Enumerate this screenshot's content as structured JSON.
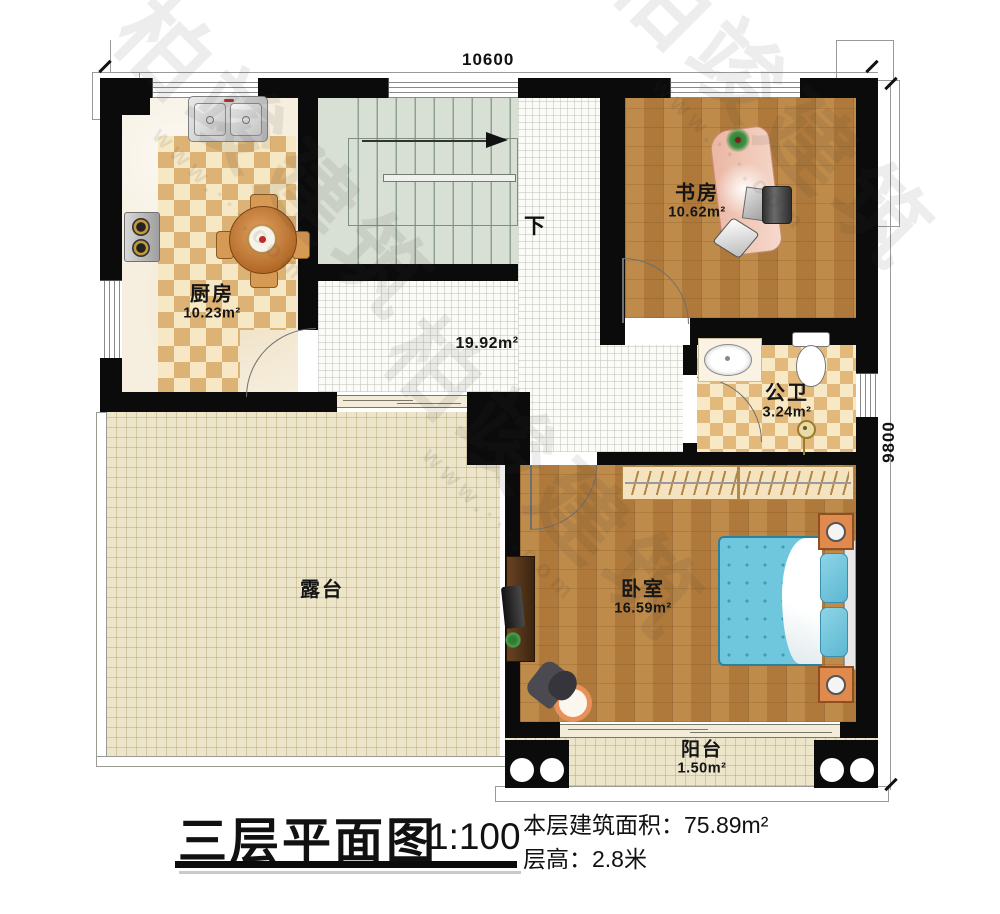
{
  "dimensions": {
    "top": "10600",
    "right": "9800"
  },
  "stairs": {
    "down_label": "下"
  },
  "rooms": {
    "kitchen": {
      "name": "厨房",
      "area": "10.23m²"
    },
    "study": {
      "name": "书房",
      "area": "10.62m²"
    },
    "bathroom": {
      "name": "公卫",
      "area": "3.24m²"
    },
    "bedroom": {
      "name": "卧室",
      "area": "16.59m²"
    },
    "hallway": {
      "area": "19.92m²"
    },
    "terrace": {
      "name": "露台"
    },
    "balcony": {
      "name": "阳台",
      "area": "1.50m²"
    }
  },
  "title_block": {
    "title": "三层平面图",
    "scale": "1:100",
    "area_label": "本层建筑面积：",
    "area_value": "75.89m²",
    "height_label": "层高：",
    "height_value": "2.8米"
  },
  "watermark": {
    "text": "柏竣建筑",
    "url": "www.···.com"
  },
  "colors": {
    "wall": "#0b0b0b",
    "wood_floor": "#b8813f",
    "checker_tile": "#ddb275",
    "terrace_tile": "#ece5ca",
    "stair_tread": "#d8dfd4",
    "bed_blue": "#6fc7de",
    "desk_salmon": "#ecb5a2",
    "nightstand_orange": "#e08a4e"
  }
}
